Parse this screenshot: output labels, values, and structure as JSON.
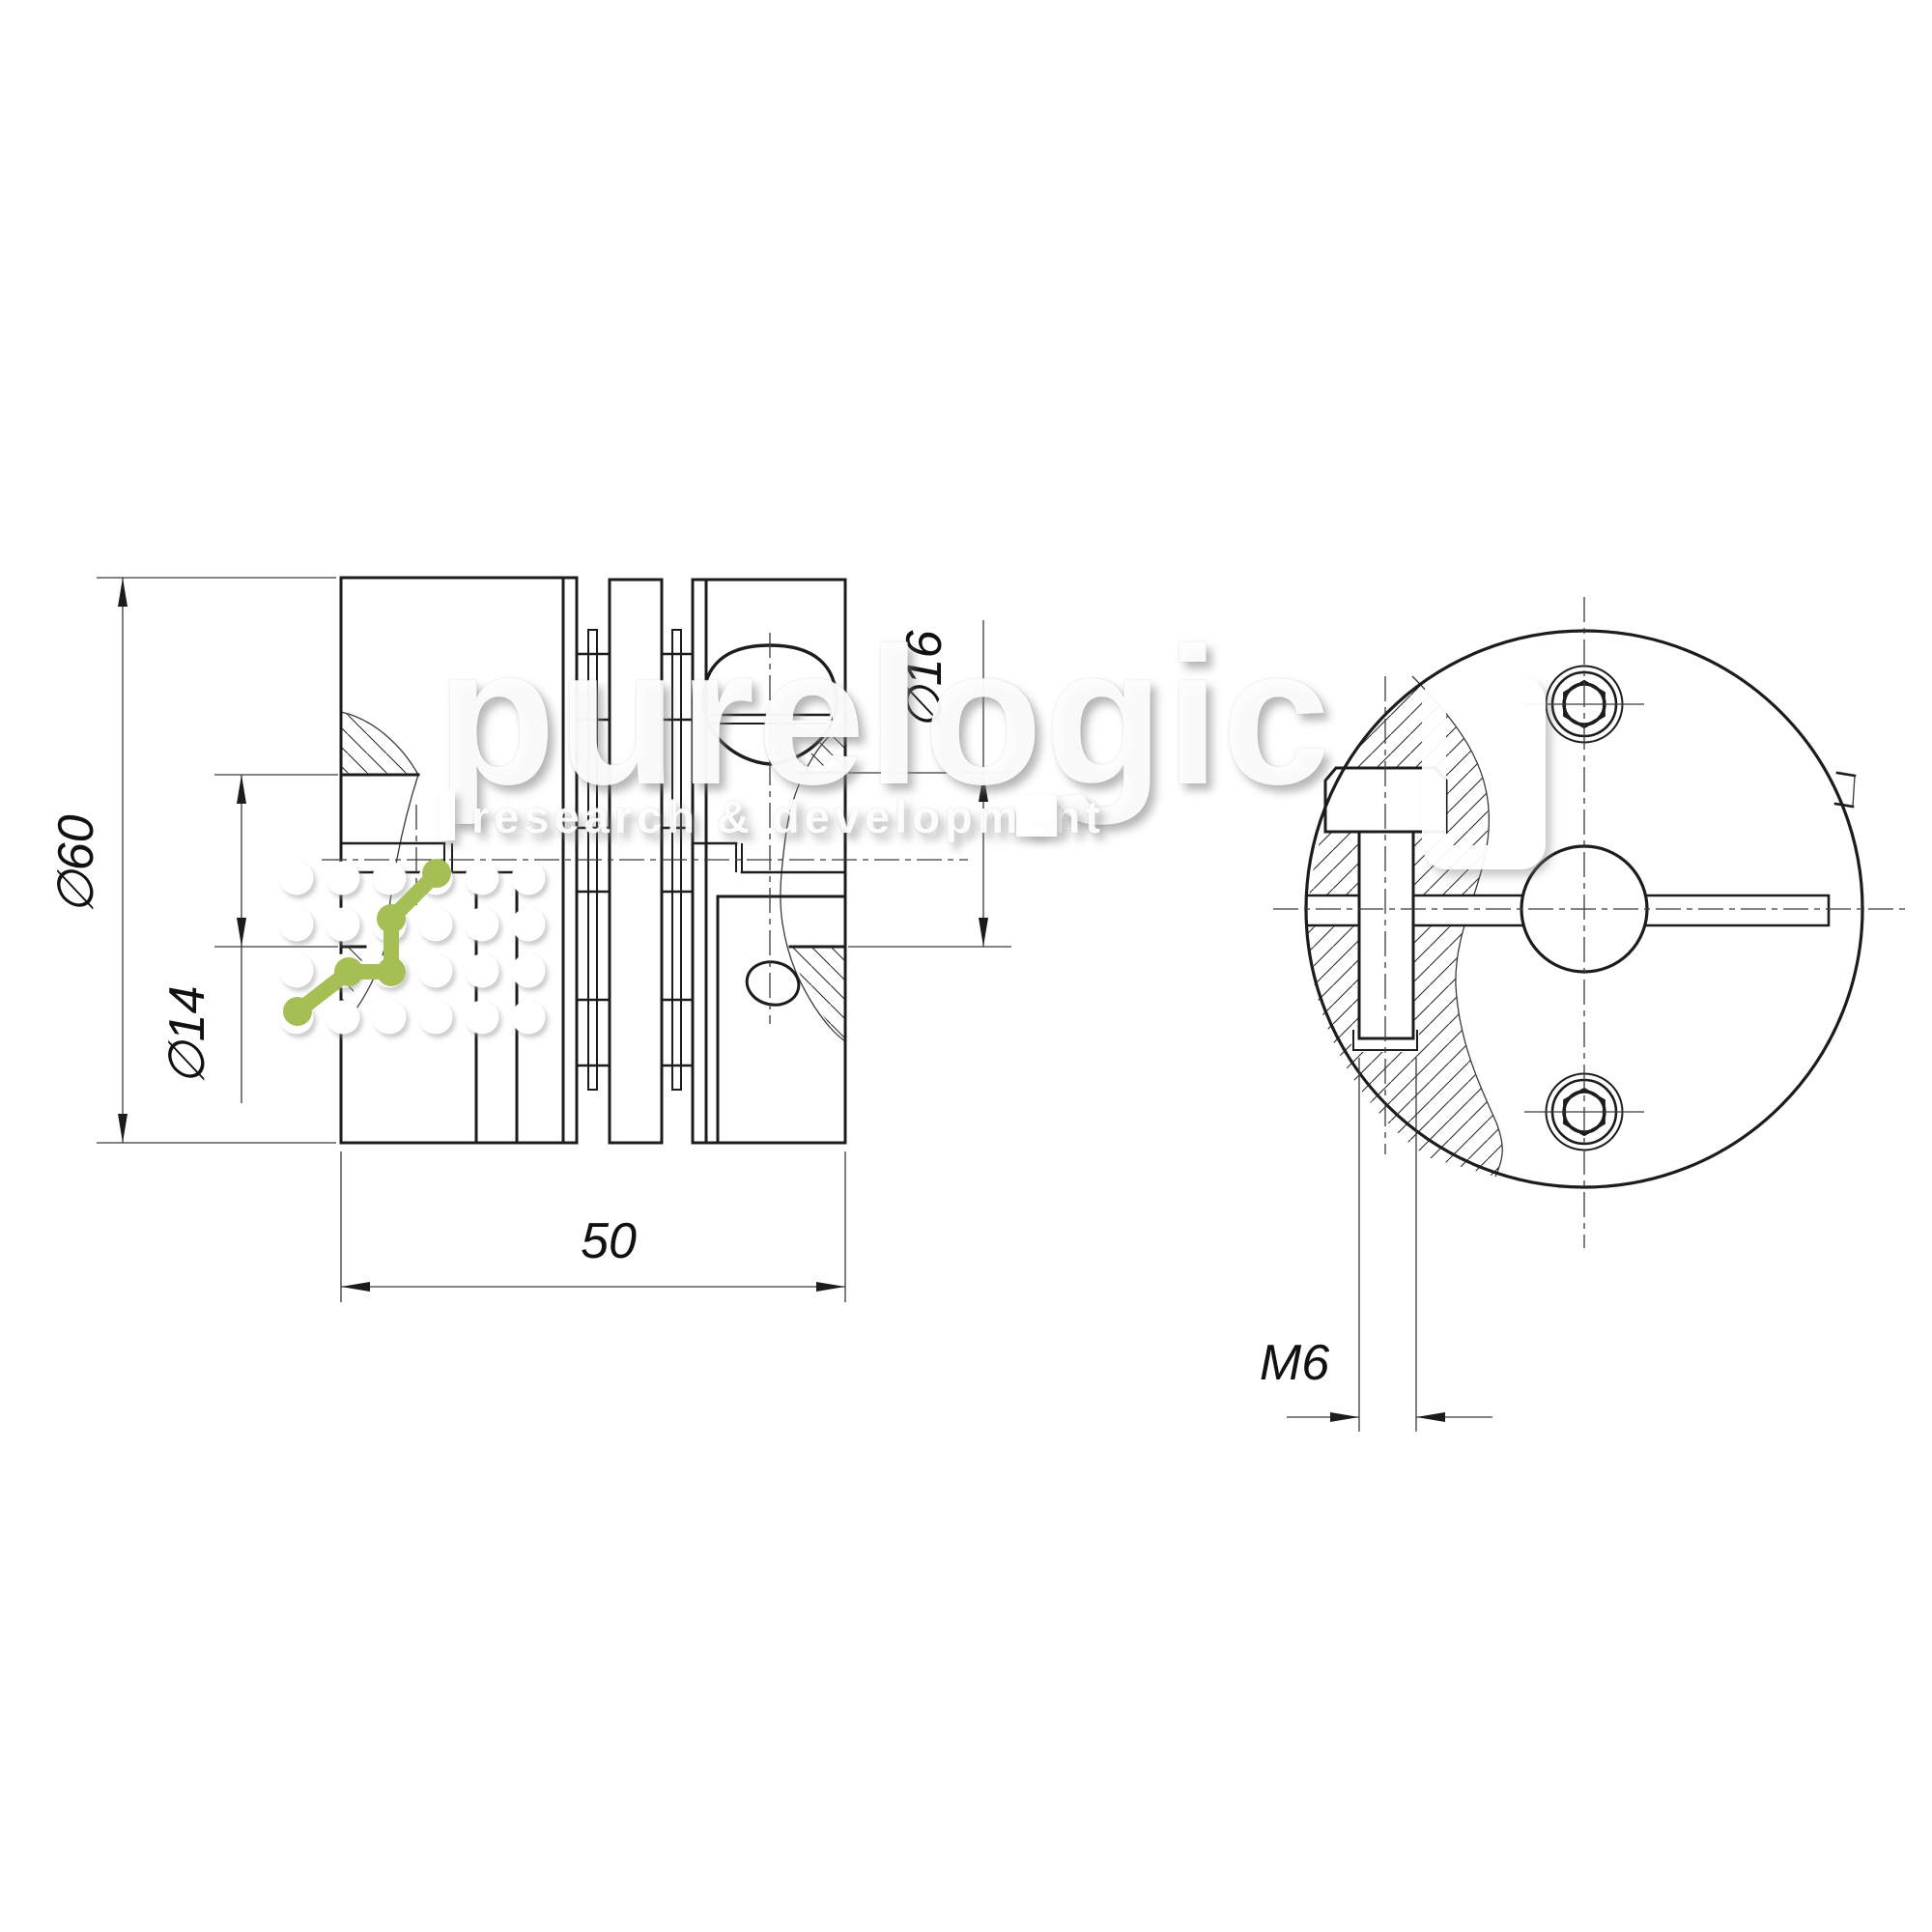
{
  "drawing": {
    "type": "coupling technical drawing, section view and front view",
    "dims": {
      "d60": "∅60",
      "d14": "∅14",
      "d16": "∅16",
      "len50": "50",
      "m6": "M6"
    },
    "colors": {
      "line": "#1c1c1c",
      "thin_line": "#3a3a3a",
      "accent_green": "#a6bf55",
      "watermark": "rgba(255,255,255,0.93)"
    }
  },
  "watermark": {
    "brand": "purelogic",
    "tagline": "research & development"
  }
}
